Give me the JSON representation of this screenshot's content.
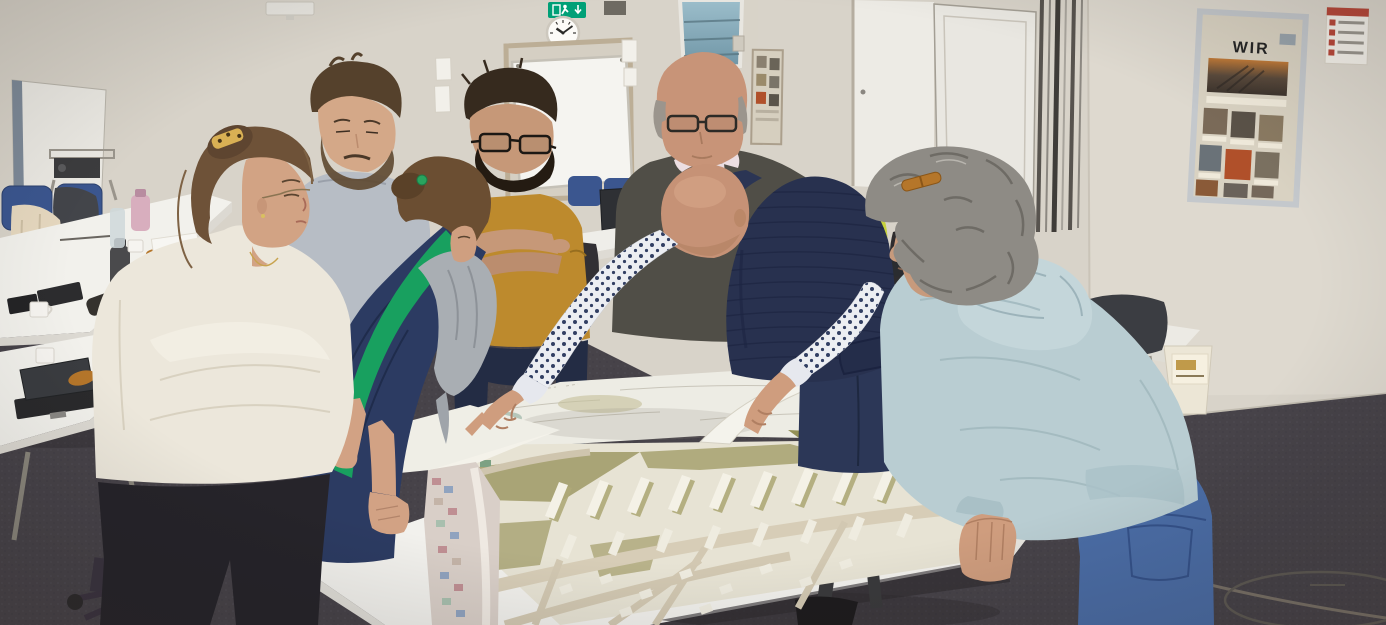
{
  "scene": {
    "description": "Seven workshop participants stand around a large white table studying a 3D architectural site model and large printed plans in a seminar room",
    "setting": "seminar room with warm white walls, dark gray carpet, white trestle tables",
    "clock_time": "10:09"
  },
  "wall_items": {
    "exit_sign": {
      "meaning": "emergency exit",
      "color": "#00a077"
    },
    "clock": {
      "time": "10:09"
    },
    "wir_poster": {
      "title": "WIR",
      "frame": "silver",
      "content": "photo board with walkway and door photos"
    },
    "emergency_sheet": {
      "type": "evacuation notice"
    },
    "partition": "movable white wall panel with vertical rails",
    "doors": [
      "center door with glass transom",
      "white door right of center"
    ]
  },
  "people": [
    {
      "id": "woman-cream-sweater",
      "position": "front-left",
      "hair": "brown updo, leopard-print claw clip",
      "clothing": "cream ribbed sweater, black trousers",
      "accessories": "glasses, thin gold necklace",
      "pose": "profile, arms folded, looking down"
    },
    {
      "id": "man-gray-sweater",
      "position": "back-left",
      "hair": "short brown hair, beard",
      "clothing": "light gray-blue sweater",
      "pose": "looking down at table"
    },
    {
      "id": "woman-navy-jacket",
      "position": "left-center",
      "hair": "brown low bun, green hair tie",
      "clothing": "navy jacket with green stripe, gray scarf",
      "pose": "bent over table, hands on tabletop"
    },
    {
      "id": "man-mustard-shirt",
      "position": "center-back",
      "hair": "dark brown hair, full beard",
      "clothing": "mustard t-shirt, dark jeans",
      "accessories": "black rimmed glasses",
      "pose": "arms crossed, looking down"
    },
    {
      "id": "man-navy-vest",
      "position": "center-front",
      "hair": "bald",
      "clothing": "navy quilted vest, white shirt with navy micro print, dark jeans",
      "pose": "leaning over model, right hand pointing, left hand lifting plan corner"
    },
    {
      "id": "man-dark-zip-sweater",
      "position": "back-center",
      "hair": "bald, gray sides",
      "clothing": "charcoal quarter-zip over light collared shirt",
      "accessories": "glasses",
      "pose": "standing, looking down"
    },
    {
      "id": "woman-light-blue-hoodie",
      "position": "front-right",
      "hair": "curly gray, sunglasses on top",
      "clothing": "light blue hoodie, blue jeans",
      "pose": "leaning forward, hand braced on table edge"
    }
  ],
  "furniture": {
    "left_tables": {
      "laptops": 3,
      "mugs": 3,
      "bottles": [
        "pink water bottle",
        "clear bottle",
        "gray thermos"
      ],
      "other": [
        "black pencil case",
        "pastry",
        "paper sheet",
        "cables"
      ]
    },
    "chairs": "blue seminar chairs on casters",
    "jackets_on_chairs": [
      "beige puffer",
      "dark gray",
      "yellow hi-vis",
      "black"
    ],
    "waste_bin": "paper bin with printed label",
    "equipment": [
      "flipchart board",
      "projector cart",
      "orange cable coil on wall outlet",
      "ceiling projector"
    ]
  },
  "model_table": {
    "model": "white and olive 3D massing model of a town district with roads and rows of long buildings",
    "plans": [
      "large printed site plan with corner lifted",
      "colorful plan hanging over table edge"
    ]
  },
  "floor": {
    "carpet_color": "#474349",
    "features": [
      "loose cable",
      "round floor access hatch"
    ]
  },
  "palette": {
    "wall": "#d8d3c9",
    "carpet": "#474349",
    "table": "#f2f1ed",
    "model_olive": "#a9a476",
    "vest_navy": "#28314f",
    "mustard": "#bd8a2d",
    "hoodie_blue": "#b9cdd2",
    "navy_jacket": "#2c3b62",
    "stripe_green": "#18a05f",
    "exit_green": "#00a077"
  }
}
